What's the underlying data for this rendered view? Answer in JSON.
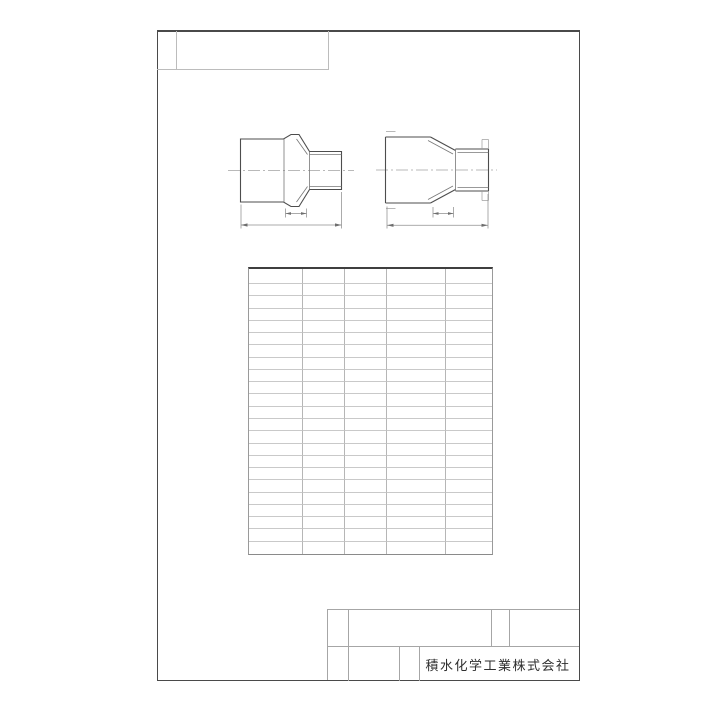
{
  "sheet": {
    "company_name": "積水化学工業株式会社"
  },
  "spec_table": {
    "rows": 23,
    "columns": 5,
    "cells_empty": true
  },
  "views": [
    {
      "id": "reducer-fitting-left-view"
    },
    {
      "id": "reducer-fitting-right-view"
    }
  ],
  "colors": {
    "background": "#ffffff",
    "frame_line": "#4a4a4a",
    "drawing_line": "#4d4d4d",
    "table_grid": "#c9c9c9",
    "text": "#2e2e2e"
  }
}
